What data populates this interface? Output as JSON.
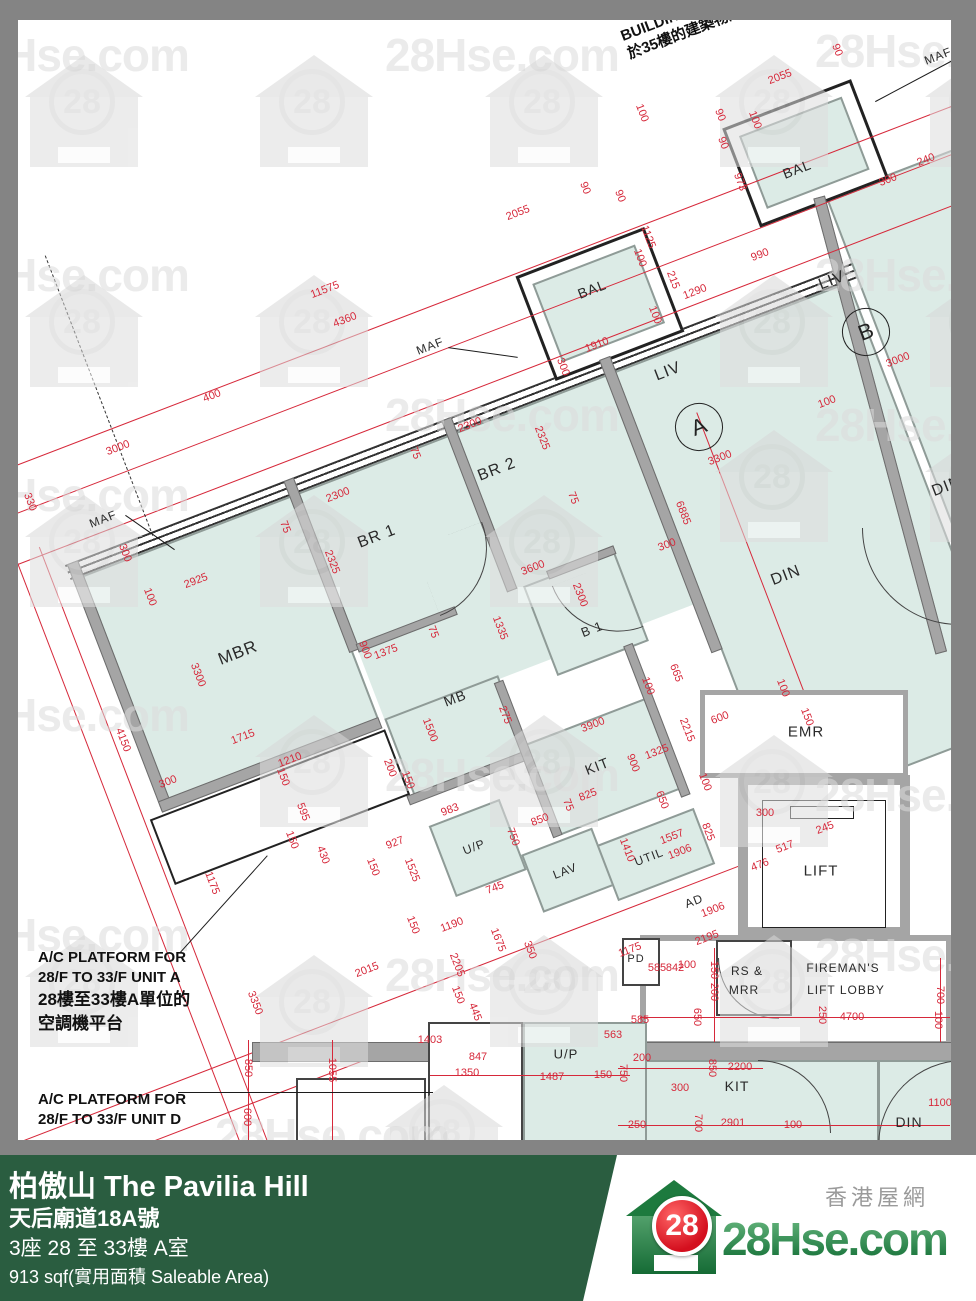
{
  "watermark": {
    "text": "28Hse.com",
    "badge": "28",
    "texts": [
      {
        "x": -45,
        "y": 28
      },
      {
        "x": 385,
        "y": 28
      },
      {
        "x": 815,
        "y": 24
      },
      {
        "x": -45,
        "y": 248
      },
      {
        "x": 815,
        "y": 248
      },
      {
        "x": -45,
        "y": 468
      },
      {
        "x": 385,
        "y": 388
      },
      {
        "x": 815,
        "y": 398
      },
      {
        "x": -45,
        "y": 688
      },
      {
        "x": 385,
        "y": 748
      },
      {
        "x": 815,
        "y": 768
      },
      {
        "x": -45,
        "y": 908
      },
      {
        "x": 385,
        "y": 948
      },
      {
        "x": 815,
        "y": 928
      },
      {
        "x": 215,
        "y": 1108
      }
    ],
    "houses": [
      {
        "x": 25,
        "y": 55
      },
      {
        "x": 255,
        "y": 55
      },
      {
        "x": 485,
        "y": 55
      },
      {
        "x": 715,
        "y": 55
      },
      {
        "x": 925,
        "y": 55
      },
      {
        "x": 25,
        "y": 275
      },
      {
        "x": 255,
        "y": 275
      },
      {
        "x": 715,
        "y": 275
      },
      {
        "x": 925,
        "y": 275
      },
      {
        "x": 25,
        "y": 495
      },
      {
        "x": 255,
        "y": 495
      },
      {
        "x": 485,
        "y": 495
      },
      {
        "x": 715,
        "y": 430
      },
      {
        "x": 925,
        "y": 430
      },
      {
        "x": 255,
        "y": 715
      },
      {
        "x": 485,
        "y": 715
      },
      {
        "x": 715,
        "y": 735
      },
      {
        "x": 25,
        "y": 935
      },
      {
        "x": 255,
        "y": 955
      },
      {
        "x": 485,
        "y": 935
      },
      {
        "x": 715,
        "y": 935
      },
      {
        "x": 385,
        "y": 1085
      }
    ]
  },
  "plan": {
    "labels": [
      {
        "t": "MBR",
        "x": 238,
        "y": 653,
        "r": 1,
        "s": 17
      },
      {
        "t": "BR 1",
        "x": 377,
        "y": 537,
        "r": 1,
        "s": 16
      },
      {
        "t": "BR 2",
        "x": 497,
        "y": 470,
        "r": 1,
        "s": 16
      },
      {
        "t": "LIV",
        "x": 668,
        "y": 372,
        "r": 1,
        "s": 16
      },
      {
        "t": "DIN",
        "x": 786,
        "y": 576,
        "r": 1,
        "s": 16
      },
      {
        "t": "BAL",
        "x": 592,
        "y": 289,
        "r": 1,
        "s": 14
      },
      {
        "t": "LIV",
        "x": 832,
        "y": 281,
        "r": 1,
        "s": 16
      },
      {
        "t": "DIN",
        "x": 947,
        "y": 487,
        "r": 1,
        "s": 16
      },
      {
        "t": "BAL",
        "x": 797,
        "y": 169,
        "r": 1,
        "s": 14
      },
      {
        "t": "MB",
        "x": 455,
        "y": 698,
        "r": 1,
        "s": 14
      },
      {
        "t": "B 1",
        "x": 592,
        "y": 629,
        "r": 1,
        "s": 13
      },
      {
        "t": "KIT",
        "x": 597,
        "y": 766,
        "r": 1,
        "s": 14
      },
      {
        "t": "LAV",
        "x": 565,
        "y": 871,
        "r": 1,
        "s": 12
      },
      {
        "t": "UTIL",
        "x": 649,
        "y": 857,
        "r": 1,
        "s": 12
      },
      {
        "t": "U/P",
        "x": 474,
        "y": 847,
        "r": 1,
        "s": 12
      },
      {
        "t": "AD",
        "x": 694,
        "y": 901,
        "r": 1,
        "s": 12
      },
      {
        "t": "MAF",
        "x": 103,
        "y": 519,
        "r": 1,
        "s": 12
      },
      {
        "t": "MAF",
        "x": 938,
        "y": 56,
        "r": 1,
        "s": 12
      },
      {
        "t": "MAF",
        "x": 430,
        "y": 346,
        "r": 1,
        "s": 12
      },
      {
        "t": "EMR",
        "x": 806,
        "y": 732,
        "r": 0,
        "s": 15
      },
      {
        "t": "LIFT",
        "x": 821,
        "y": 871,
        "r": 0,
        "s": 15
      },
      {
        "t": "RS &",
        "x": 747,
        "y": 971,
        "r": 0,
        "s": 12
      },
      {
        "t": "MRR",
        "x": 744,
        "y": 990,
        "r": 0,
        "s": 12
      },
      {
        "t": "FIREMAN'S",
        "x": 843,
        "y": 968,
        "r": 0,
        "s": 12
      },
      {
        "t": "LIFT LOBBY",
        "x": 846,
        "y": 990,
        "r": 0,
        "s": 12
      },
      {
        "t": "PD",
        "x": 636,
        "y": 959,
        "r": 0,
        "s": 11
      },
      {
        "t": "U/P",
        "x": 566,
        "y": 1054,
        "r": 0,
        "s": 13
      },
      {
        "t": "KIT",
        "x": 737,
        "y": 1086,
        "r": 0,
        "s": 14
      },
      {
        "t": "DIN",
        "x": 909,
        "y": 1122,
        "r": 0,
        "s": 14
      }
    ],
    "circles": [
      {
        "t": "A",
        "x": 699,
        "y": 427
      },
      {
        "t": "B",
        "x": 866,
        "y": 332
      }
    ],
    "dims": [
      [
        "2055",
        780,
        77,
        1
      ],
      [
        "90",
        837,
        50,
        2
      ],
      [
        "100",
        642,
        113,
        2
      ],
      [
        "90",
        720,
        115,
        2
      ],
      [
        "90",
        723,
        143,
        2
      ],
      [
        "973",
        740,
        182,
        2
      ],
      [
        "100",
        755,
        120,
        2
      ],
      [
        "240",
        926,
        160,
        1
      ],
      [
        "300",
        888,
        180,
        1
      ],
      [
        "2055",
        518,
        213,
        1
      ],
      [
        "90",
        585,
        188,
        2
      ],
      [
        "90",
        620,
        196,
        2
      ],
      [
        "1125",
        648,
        237,
        2
      ],
      [
        "100",
        640,
        258,
        2
      ],
      [
        "215",
        673,
        280,
        2
      ],
      [
        "1290",
        695,
        292,
        1
      ],
      [
        "100",
        655,
        315,
        2
      ],
      [
        "1910",
        597,
        345,
        1
      ],
      [
        "300",
        563,
        367,
        2
      ],
      [
        "990",
        760,
        255,
        1
      ],
      [
        "3000",
        898,
        360,
        1
      ],
      [
        "100",
        827,
        402,
        1
      ],
      [
        "3300",
        720,
        458,
        1
      ],
      [
        "6885",
        683,
        513,
        2
      ],
      [
        "300",
        667,
        545,
        1
      ],
      [
        "11575",
        325,
        290,
        1
      ],
      [
        "4360",
        345,
        320,
        1
      ],
      [
        "400",
        212,
        396,
        1
      ],
      [
        "3000",
        118,
        448,
        1
      ],
      [
        "330",
        30,
        502,
        2
      ],
      [
        "90",
        10,
        545,
        2
      ],
      [
        "300",
        125,
        553,
        2
      ],
      [
        "100",
        150,
        597,
        2
      ],
      [
        "2925",
        196,
        581,
        1
      ],
      [
        "2300",
        470,
        425,
        1
      ],
      [
        "2325",
        542,
        438,
        2
      ],
      [
        "75",
        415,
        453,
        2
      ],
      [
        "2300",
        338,
        495,
        1
      ],
      [
        "75",
        573,
        498,
        2
      ],
      [
        "75",
        285,
        527,
        2
      ],
      [
        "2325",
        332,
        562,
        2
      ],
      [
        "3600",
        533,
        568,
        1
      ],
      [
        "2300",
        580,
        595,
        2
      ],
      [
        "3300",
        198,
        675,
        2
      ],
      [
        "4150",
        123,
        740,
        2
      ],
      [
        "1715",
        243,
        737,
        1
      ],
      [
        "75",
        433,
        632,
        2
      ],
      [
        "900",
        365,
        650,
        2
      ],
      [
        "1375",
        386,
        652,
        1
      ],
      [
        "1335",
        500,
        628,
        2
      ],
      [
        "1210",
        290,
        760,
        1
      ],
      [
        "300",
        168,
        782,
        1
      ],
      [
        "150",
        283,
        777,
        2
      ],
      [
        "595",
        303,
        812,
        2
      ],
      [
        "150",
        292,
        840,
        2
      ],
      [
        "430",
        323,
        855,
        2
      ],
      [
        "150",
        373,
        867,
        2
      ],
      [
        "927",
        395,
        843,
        1
      ],
      [
        "1525",
        412,
        870,
        2
      ],
      [
        "983",
        450,
        810,
        1
      ],
      [
        "1175",
        212,
        883,
        2
      ],
      [
        "1190",
        452,
        925,
        1
      ],
      [
        "150",
        413,
        925,
        2
      ],
      [
        "2205",
        457,
        965,
        2
      ],
      [
        "150",
        458,
        995,
        2
      ],
      [
        "2015",
        367,
        970,
        1
      ],
      [
        "3350",
        255,
        1003,
        2
      ],
      [
        "1675",
        498,
        940,
        2
      ],
      [
        "350",
        530,
        950,
        2
      ],
      [
        "445",
        475,
        1012,
        2
      ],
      [
        "275",
        505,
        715,
        2
      ],
      [
        "1500",
        430,
        730,
        2
      ],
      [
        "200",
        390,
        768,
        2
      ],
      [
        "150",
        408,
        780,
        2
      ],
      [
        "3900",
        593,
        725,
        1
      ],
      [
        "665",
        676,
        673,
        2
      ],
      [
        "100",
        648,
        686,
        2
      ],
      [
        "2215",
        687,
        730,
        2
      ],
      [
        "900",
        633,
        763,
        2
      ],
      [
        "1325",
        657,
        752,
        1
      ],
      [
        "600",
        720,
        718,
        1
      ],
      [
        "100",
        705,
        782,
        2
      ],
      [
        "650",
        662,
        800,
        2
      ],
      [
        "825",
        588,
        795,
        1
      ],
      [
        "75",
        568,
        805,
        2
      ],
      [
        "850",
        540,
        820,
        1
      ],
      [
        "750",
        513,
        837,
        2
      ],
      [
        "745",
        495,
        888,
        1
      ],
      [
        "1410",
        627,
        850,
        2
      ],
      [
        "1557",
        672,
        837,
        1
      ],
      [
        "1906",
        680,
        852,
        1
      ],
      [
        "825",
        708,
        832,
        2
      ],
      [
        "100",
        783,
        688,
        2
      ],
      [
        "150",
        807,
        717,
        2
      ],
      [
        "245",
        825,
        828,
        1
      ],
      [
        "517",
        785,
        847,
        1
      ],
      [
        "476",
        760,
        865,
        1
      ],
      [
        "300",
        765,
        813,
        0
      ],
      [
        "1906",
        713,
        910,
        1
      ],
      [
        "2195",
        707,
        938,
        1
      ],
      [
        "1175",
        630,
        950,
        1
      ],
      [
        "842",
        675,
        968,
        0
      ],
      [
        "100",
        687,
        965,
        0
      ],
      [
        "585",
        657,
        968,
        0
      ],
      [
        "150",
        714,
        970,
        3
      ],
      [
        "200",
        714,
        992,
        3
      ],
      [
        "650",
        697,
        1017,
        3
      ],
      [
        "250",
        822,
        1015,
        3
      ],
      [
        "4700",
        852,
        1017,
        0
      ],
      [
        "700",
        940,
        995,
        3
      ],
      [
        "100",
        938,
        1020,
        3
      ],
      [
        "585",
        640,
        1020,
        0
      ],
      [
        "200",
        642,
        1058,
        0
      ],
      [
        "850",
        712,
        1068,
        3
      ],
      [
        "300",
        680,
        1088,
        0
      ],
      [
        "2200",
        740,
        1067,
        0
      ],
      [
        "700",
        698,
        1123,
        3
      ],
      [
        "2901",
        733,
        1123,
        0
      ],
      [
        "100",
        793,
        1125,
        0
      ],
      [
        "250",
        637,
        1125,
        0
      ],
      [
        "1100",
        940,
        1103,
        0
      ],
      [
        "850",
        248,
        1068,
        3
      ],
      [
        "600",
        247,
        1117,
        3
      ],
      [
        "1055",
        332,
        1070,
        3
      ],
      [
        "1403",
        430,
        1040,
        0
      ],
      [
        "847",
        478,
        1057,
        0
      ],
      [
        "1350",
        467,
        1073,
        0
      ],
      [
        "1487",
        552,
        1077,
        0
      ],
      [
        "150",
        603,
        1075,
        0
      ],
      [
        "750",
        623,
        1073,
        3
      ],
      [
        "563",
        613,
        1035,
        0
      ]
    ],
    "notes": {
      "ac_a": [
        "A/C PLATFORM FOR",
        "28/F TO 33/F UNIT A",
        "28樓至33樓A單位的",
        "空調機平台"
      ],
      "ac_d": [
        "A/C PLATFORM FOR",
        "28/F TO 33/F UNIT D"
      ],
      "building_line": [
        "BUILDING LINE",
        "於35樓的建築物邊"
      ]
    }
  },
  "footer": {
    "title": "柏傲山 The Pavilia Hill",
    "address": "天后廟道18A號",
    "block": "3座 28 至 33樓 A室",
    "area": "913 sqf(實用面積 Saleable Area)"
  },
  "logo": {
    "site": "28Hse.com",
    "badge": "28",
    "tagline": "香港屋網"
  }
}
